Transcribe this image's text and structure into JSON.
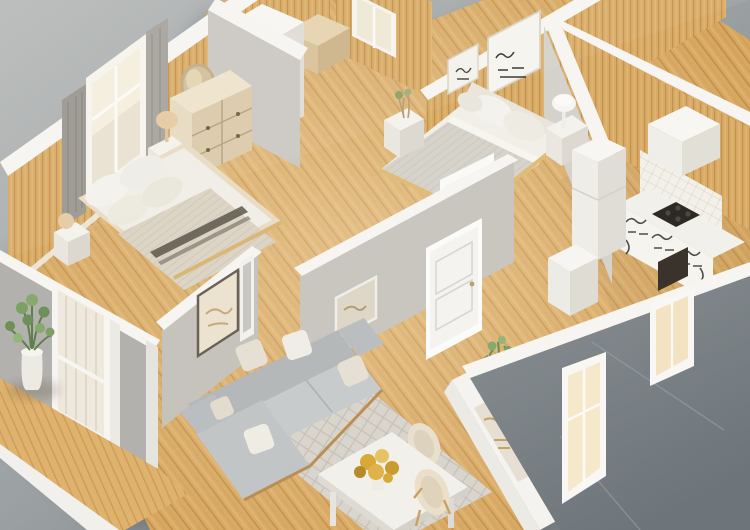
{
  "scene": {
    "type": "3d-isometric-cutaway-floor-plan-render",
    "subject": "small apartment with two bedrooms, kitchen, hallway and open living-dining room",
    "view": "aerial isometric, roof removed, white-capped walls",
    "floor_finish": "light oak plank flooring",
    "wall_finish": "vertical wood paneling in bedrooms and kitchen, gray exterior facade",
    "background": "plain gray studio backdrop"
  },
  "palette": {
    "bg_top_left": "#babcbb",
    "bg_mid": "#9aa0a2",
    "bg_bottom_right": "#6f767b",
    "wall_cap": "#f6f5f1",
    "wood_wall": "#d8ab66",
    "wood_wall_line": "#c2914d",
    "floor_wood": "#d7a65f",
    "floor_wood_line": "#c08e48",
    "deck_wood": "#dfb26e",
    "exterior_gray": "#8a9094",
    "exterior_gray_dark": "#6e757a",
    "facade_left_gray": "#b2b1ad",
    "interior_gray": "#cac7c1",
    "sofa_gray": "#c8cbcc",
    "sofa_gray_dark": "#b4b8b9",
    "cushion_beige": "#e6e0d4",
    "white_surface": "#f2f0ea",
    "wood_furniture": "#e8dbc2",
    "blanket_beige": "#dcd5c6",
    "blanket_stripe": "#5d564a",
    "blanket_gray": "#d6d3cc",
    "rug": "#d9d5cd",
    "rug_line": "#c5c1b8",
    "plant_green": "#6f8f5a",
    "flower_gold": "#d8a937",
    "lamp_beige": "#e5cba4",
    "tile": "#f3f0e9",
    "scribble_dark": "#35302a",
    "window_light": "#f6e8cb"
  },
  "rooms": {
    "bedroom_1": {
      "label": "bedroom 1 (top left)",
      "items": [
        "double bed with knit throw and dark accent stripe",
        "white pillows",
        "bedside table with beige table lamp",
        "small cube table with ball lamp",
        "three-drawer wood dresser",
        "round wood-framed mirror",
        "tall white wardrobe",
        "wooden storage chest",
        "window with gray curtains"
      ]
    },
    "bedroom_2": {
      "label": "bedroom 2 (top right)",
      "items": [
        "double bed with light gray blanket",
        "white pillows",
        "two framed wall prints",
        "bedside table with small plant",
        "bedside table with white lamp",
        "small back window"
      ]
    },
    "kitchen": {
      "label": "kitchen (right)",
      "items": [
        "refrigerator",
        "white counter with patterned cabinet fronts",
        "dark cooktop and oven front",
        "white range hood cabinet",
        "white tiled backsplash",
        "white storage cube"
      ]
    },
    "living_dining": {
      "label": "open living-dining room (bottom)",
      "items": [
        "l-shaped gray sectional sofa with throw pillows",
        "diamond-pattern area rug",
        "white dining table",
        "gold flower centerpiece",
        "two cream dining chairs",
        "framed artwork on wall",
        "white console shelf with plant and decor"
      ]
    },
    "hallway": {
      "label": "central hallway",
      "items": [
        "white paneled interior doors",
        "framed artwork",
        "narrow mirror panel"
      ]
    },
    "exterior": {
      "label": "exterior",
      "items": [
        "wooden deck strip",
        "potted green plant",
        "glass door with sheer curtain",
        "gray facade walls",
        "two lit facade windows"
      ]
    }
  }
}
